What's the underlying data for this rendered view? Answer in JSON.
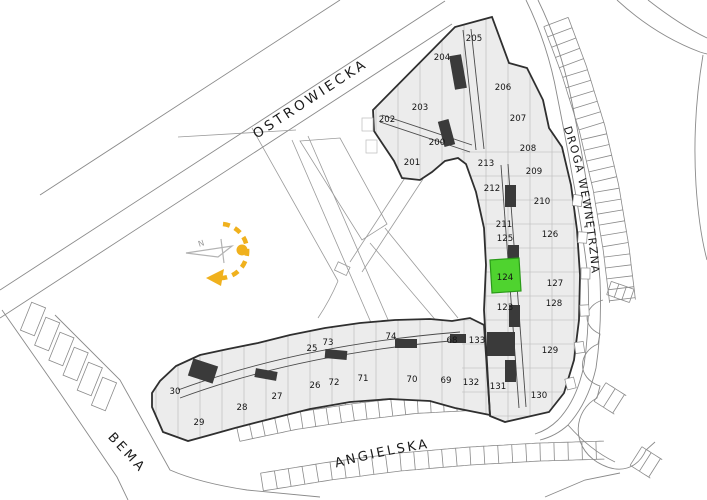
{
  "map": {
    "title": "Site plan with apartment units",
    "streets": [
      {
        "id": "ostrowiecka",
        "label": "OSTROWIECKA"
      },
      {
        "id": "droga-wewnetrzna",
        "label": "DROGA WEWNĘTRZNA"
      },
      {
        "id": "angielska",
        "label": "ANGIELSKA"
      },
      {
        "id": "bema",
        "label": "BEMA"
      }
    ],
    "compass": {
      "label": "N"
    },
    "selected_unit": "124",
    "units": [
      {
        "number": "200",
        "x": 437,
        "y": 142
      },
      {
        "number": "201",
        "x": 412,
        "y": 162
      },
      {
        "number": "202",
        "x": 387,
        "y": 119
      },
      {
        "number": "203",
        "x": 420,
        "y": 107
      },
      {
        "number": "204",
        "x": 442,
        "y": 57
      },
      {
        "number": "205",
        "x": 474,
        "y": 38
      },
      {
        "number": "206",
        "x": 503,
        "y": 87
      },
      {
        "number": "207",
        "x": 518,
        "y": 118
      },
      {
        "number": "208",
        "x": 528,
        "y": 148
      },
      {
        "number": "209",
        "x": 534,
        "y": 171
      },
      {
        "number": "210",
        "x": 542,
        "y": 201
      },
      {
        "number": "211",
        "x": 504,
        "y": 224
      },
      {
        "number": "212",
        "x": 492,
        "y": 188
      },
      {
        "number": "213",
        "x": 486,
        "y": 163
      },
      {
        "number": "123",
        "x": 505,
        "y": 307
      },
      {
        "number": "124",
        "x": 505,
        "y": 277,
        "highlighted": true
      },
      {
        "number": "125",
        "x": 505,
        "y": 238
      },
      {
        "number": "126",
        "x": 550,
        "y": 234
      },
      {
        "number": "127",
        "x": 555,
        "y": 283
      },
      {
        "number": "128",
        "x": 554,
        "y": 303
      },
      {
        "number": "129",
        "x": 550,
        "y": 350
      },
      {
        "number": "130",
        "x": 539,
        "y": 395
      },
      {
        "number": "131",
        "x": 498,
        "y": 386
      },
      {
        "number": "132",
        "x": 471,
        "y": 382
      },
      {
        "number": "133",
        "x": 477,
        "y": 340
      },
      {
        "number": "25",
        "x": 312,
        "y": 348
      },
      {
        "number": "26",
        "x": 315,
        "y": 385
      },
      {
        "number": "27",
        "x": 277,
        "y": 396
      },
      {
        "number": "28",
        "x": 242,
        "y": 407
      },
      {
        "number": "29",
        "x": 199,
        "y": 422
      },
      {
        "number": "30",
        "x": 175,
        "y": 391
      },
      {
        "number": "68",
        "x": 452,
        "y": 340
      },
      {
        "number": "69",
        "x": 446,
        "y": 380
      },
      {
        "number": "70",
        "x": 412,
        "y": 379
      },
      {
        "number": "71",
        "x": 363,
        "y": 378
      },
      {
        "number": "72",
        "x": 334,
        "y": 382
      },
      {
        "number": "73",
        "x": 328,
        "y": 342
      },
      {
        "number": "74",
        "x": 391,
        "y": 336
      }
    ],
    "colors": {
      "highlight": "#4fd32f",
      "highlight_border": "#2a9a18",
      "highlight_text": "#1f5c12",
      "compass_yellow": "#f0b11d",
      "compass_gray": "#b3b3b3",
      "building_fill": "#ececec",
      "wall": "#2f2f2f",
      "thin_line": "#9c9c9c",
      "street_line": "#8a8a8a",
      "label_color": "#1b1b1b"
    }
  }
}
